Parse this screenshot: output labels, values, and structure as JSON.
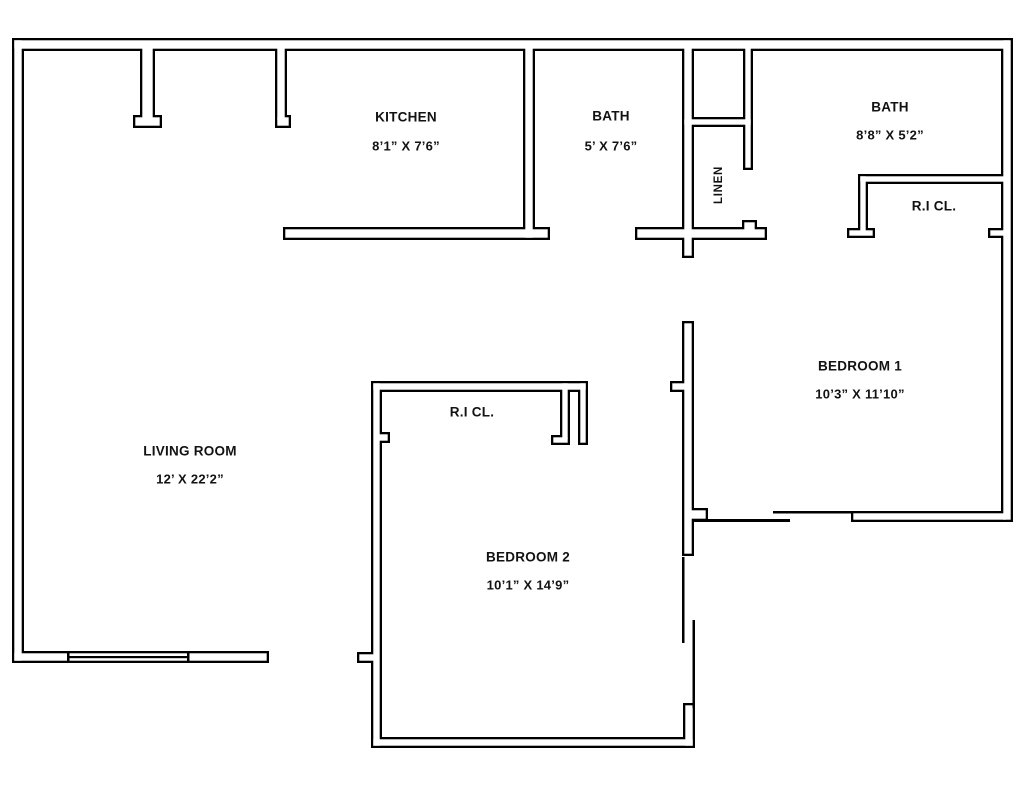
{
  "floorplan": {
    "background": "#ffffff",
    "wall_color": "#000000",
    "wall_fill": "#ffffff",
    "wall_stroke_px": 2.3,
    "walls": [
      [
        12,
        38,
        1000,
        13
      ],
      [
        12,
        38,
        12,
        625
      ],
      [
        1001,
        38,
        12,
        484
      ],
      [
        12,
        651,
        257,
        12
      ],
      [
        140,
        45,
        15,
        77
      ],
      [
        133,
        115,
        29,
        13
      ],
      [
        275,
        45,
        12,
        77
      ],
      [
        275,
        115,
        16,
        13
      ],
      [
        283,
        227,
        267,
        13
      ],
      [
        523,
        45,
        12,
        195
      ],
      [
        635,
        227,
        132,
        13
      ],
      [
        742,
        220,
        15,
        14
      ],
      [
        682,
        45,
        12,
        213
      ],
      [
        682,
        117,
        71,
        10
      ],
      [
        743,
        45,
        10,
        125
      ],
      [
        858,
        174,
        150,
        10
      ],
      [
        858,
        174,
        10,
        60
      ],
      [
        847,
        228,
        28,
        10
      ],
      [
        988,
        228,
        20,
        10
      ],
      [
        682,
        321,
        12,
        235
      ],
      [
        688,
        508,
        20,
        13
      ],
      [
        670,
        381,
        18,
        11
      ],
      [
        851,
        511,
        157,
        11
      ],
      [
        371,
        381,
        217,
        11
      ],
      [
        560,
        381,
        10,
        60
      ],
      [
        551,
        435,
        19,
        10
      ],
      [
        578,
        381,
        10,
        64
      ],
      [
        371,
        381,
        11,
        367
      ],
      [
        376,
        432,
        14,
        11
      ],
      [
        357,
        652,
        20,
        11
      ],
      [
        371,
        737,
        324,
        11
      ],
      [
        683,
        703,
        12,
        45
      ]
    ],
    "lines": [
      [
        67,
        656,
        122,
        2.2
      ],
      [
        67,
        653,
        2.5,
        9
      ],
      [
        187,
        653,
        2.5,
        9
      ],
      [
        694,
        519,
        96,
        3
      ],
      [
        773,
        511,
        80,
        2.5
      ],
      [
        682,
        557,
        2.5,
        86
      ],
      [
        692.5,
        620,
        2.5,
        88
      ]
    ],
    "rooms": [
      {
        "id": "kitchen",
        "name": "KITCHEN",
        "dims": "8’1” X 7’6”",
        "cx": 406,
        "name_y": 117,
        "dims_y": 146
      },
      {
        "id": "bath-1",
        "name": "BATH",
        "dims": "5’ X 7’6”",
        "cx": 611,
        "name_y": 116,
        "dims_y": 146
      },
      {
        "id": "linen",
        "name": "LINEN",
        "cx": 719,
        "name_y": 185,
        "rotate": true
      },
      {
        "id": "bath-2",
        "name": "BATH",
        "dims": "8’8” X 5’2”",
        "cx": 890,
        "name_y": 107,
        "dims_y": 135
      },
      {
        "id": "ri-closet-1",
        "name": "R.I CL.",
        "cx": 934,
        "name_y": 206
      },
      {
        "id": "bedroom-1",
        "name": "BEDROOM 1",
        "dims": "10’3” X 11’10”",
        "cx": 860,
        "name_y": 366,
        "dims_y": 394
      },
      {
        "id": "living-room",
        "name": "LIVING ROOM",
        "dims": "12’ X 22’2”",
        "cx": 190,
        "name_y": 451,
        "dims_y": 479
      },
      {
        "id": "ri-closet-2",
        "name": "R.I CL.",
        "cx": 472,
        "name_y": 412
      },
      {
        "id": "bedroom-2",
        "name": "BEDROOM 2",
        "dims": "10’1” X 14’9”",
        "cx": 528,
        "name_y": 557,
        "dims_y": 585
      }
    ]
  }
}
